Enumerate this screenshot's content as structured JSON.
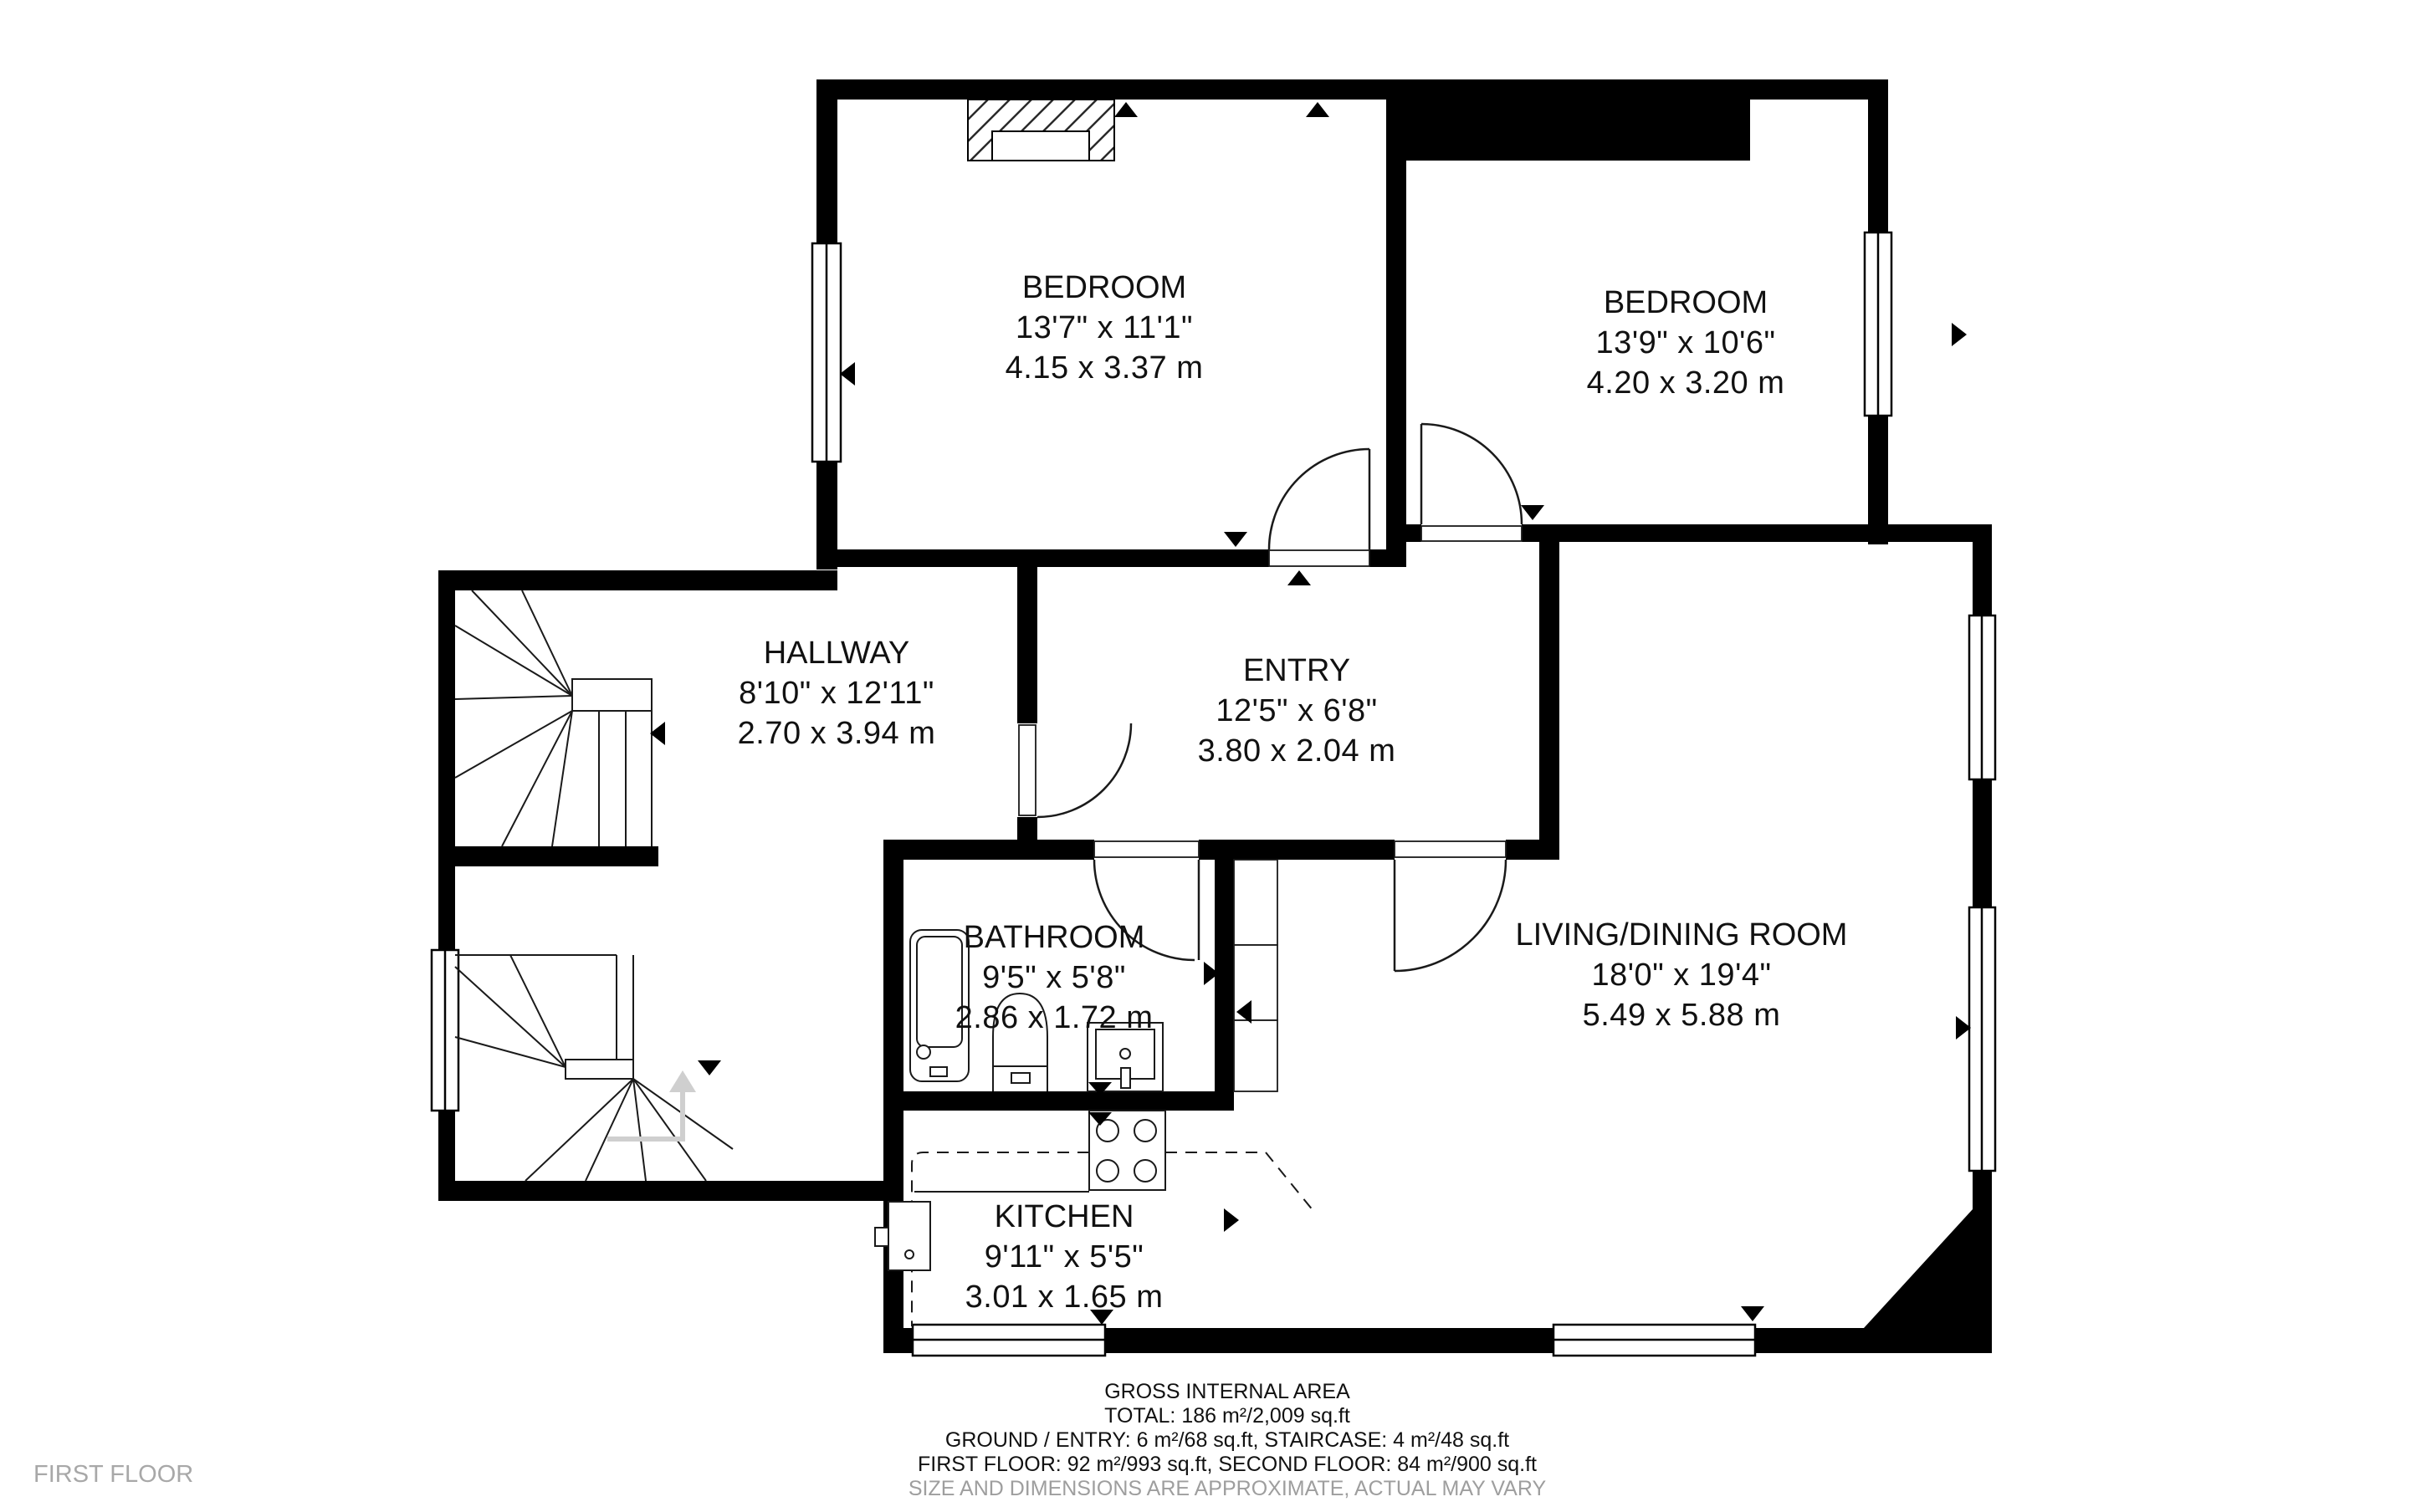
{
  "floor_label": "FIRST FLOOR",
  "rooms": {
    "bedroom1": {
      "name": "BEDROOM",
      "imperial": "13'7\" x 11'1\"",
      "metric": "4.15 x 3.37 m"
    },
    "bedroom2": {
      "name": "BEDROOM",
      "imperial": "13'9\" x 10'6\"",
      "metric": "4.20 x 3.20 m"
    },
    "hallway": {
      "name": "HALLWAY",
      "imperial": "8'10\" x 12'11\"",
      "metric": "2.70 x 3.94 m"
    },
    "entry": {
      "name": "ENTRY",
      "imperial": "12'5\" x 6'8\"",
      "metric": "3.80 x 2.04 m"
    },
    "bathroom": {
      "name": "BATHROOM",
      "imperial": "9'5\" x 5'8\"",
      "metric": "2.86 x 1.72 m"
    },
    "living": {
      "name": "LIVING/DINING ROOM",
      "imperial": "18'0\" x 19'4\"",
      "metric": "5.49 x 5.88 m"
    },
    "kitchen": {
      "name": "KITCHEN",
      "imperial": "9'11\" x 5'5\"",
      "metric": "3.01 x 1.65 m"
    }
  },
  "footer": {
    "title": "GROSS INTERNAL AREA",
    "total": "TOTAL: 186 m²/2,009 sq.ft",
    "ground": "GROUND / ENTRY: 6 m²/68 sq.ft, STAIRCASE: 4 m²/48 sq.ft",
    "floors": "FIRST FLOOR: 92 m²/993 sq.ft, SECOND FLOOR: 84 m²/900 sq.ft",
    "disclaimer": "SIZE AND DIMENSIONS ARE APPROXIMATE, ACTUAL MAY VARY"
  },
  "colors": {
    "wall": "#000000",
    "line": "#1a1a1a",
    "muted_text": "#9e9e9e",
    "floor_tag": "#a8a8a8",
    "direction_arrow": "#cfcfcf"
  }
}
